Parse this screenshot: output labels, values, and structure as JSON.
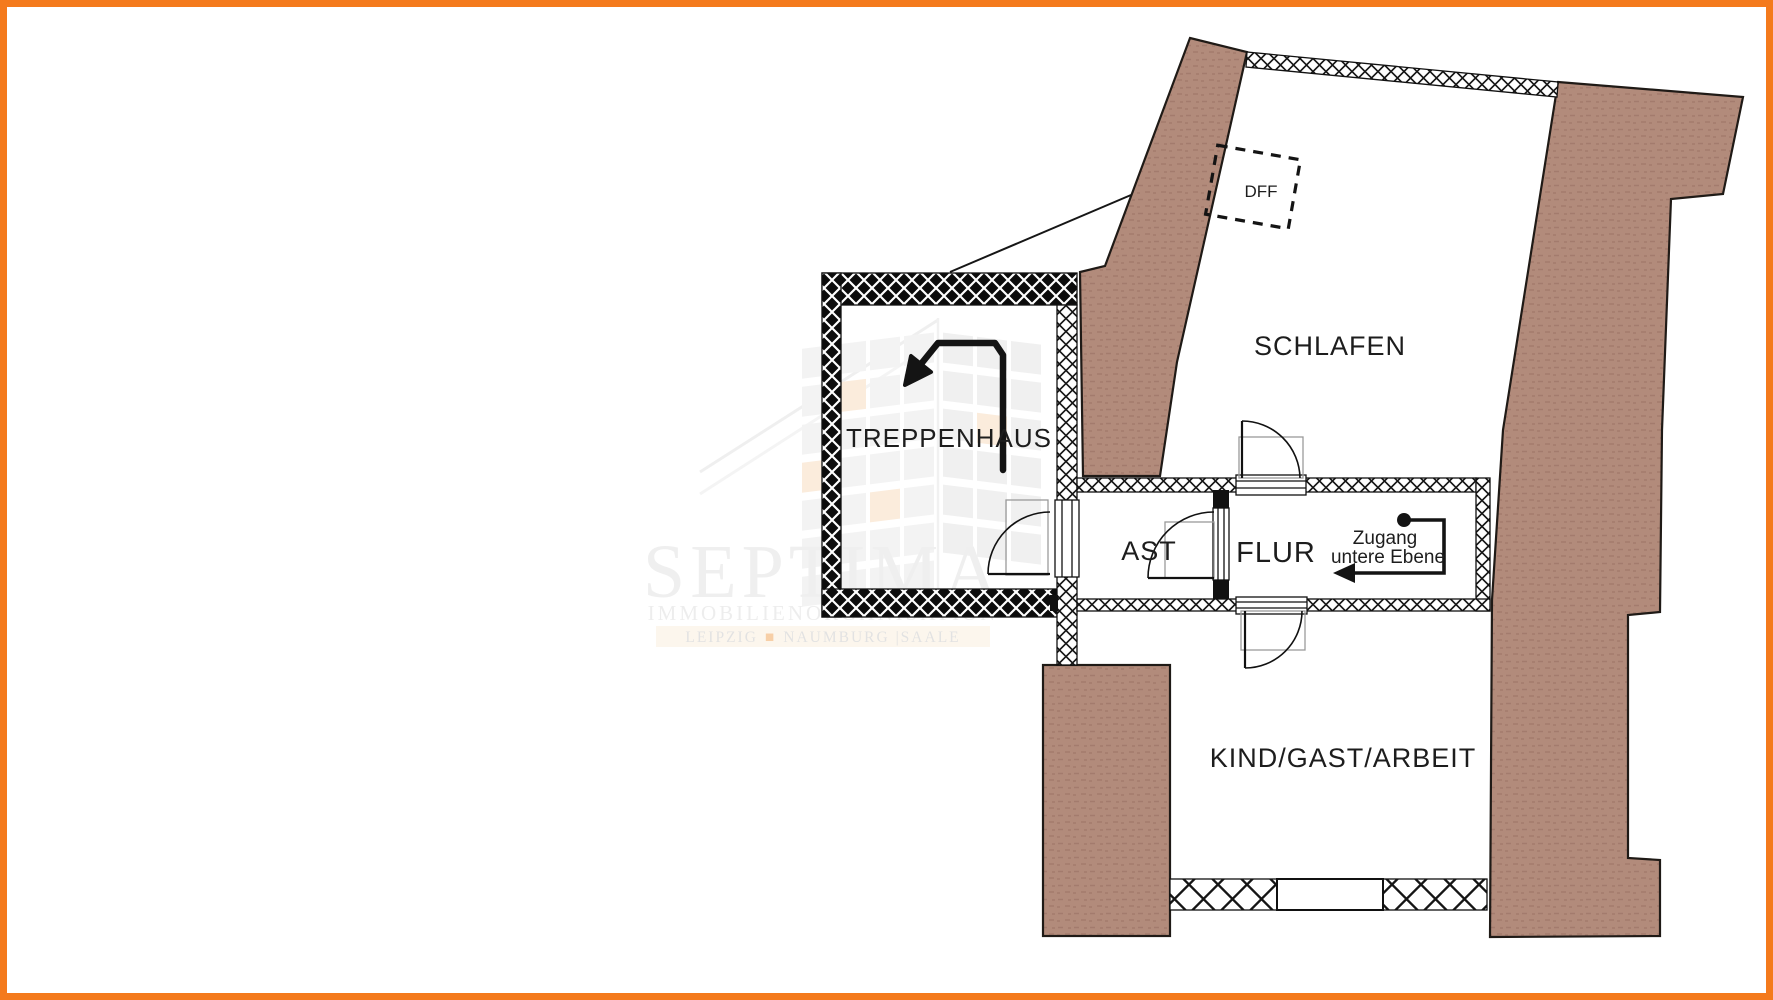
{
  "rooms": {
    "schlafen": "SCHLAFEN",
    "treppenhaus": "TREPPENHAUS",
    "ast": "AST",
    "flur": "FLUR",
    "kind": "KIND/GAST/ARBEIT"
  },
  "annotations": {
    "dff": "DFF",
    "zugang_line1": "Zugang",
    "zugang_line2": "untere Ebene"
  },
  "watermark": {
    "brand": "SEPTIMA",
    "subtitle": "IMMOBILIENORGANISATION",
    "cities_left": "LEIPZIG",
    "bullet": "■",
    "cities_right": "NAUMBURG |SAALE"
  },
  "colors": {
    "frame": "#f47a1c",
    "roof_fill": "#b28b7b",
    "roof_texture": "#9b7265",
    "wall_dark": "#0c0c0c",
    "line": "#161616",
    "watermark_gray": "#e2e2e2",
    "watermark_orange": "#f2a860"
  }
}
